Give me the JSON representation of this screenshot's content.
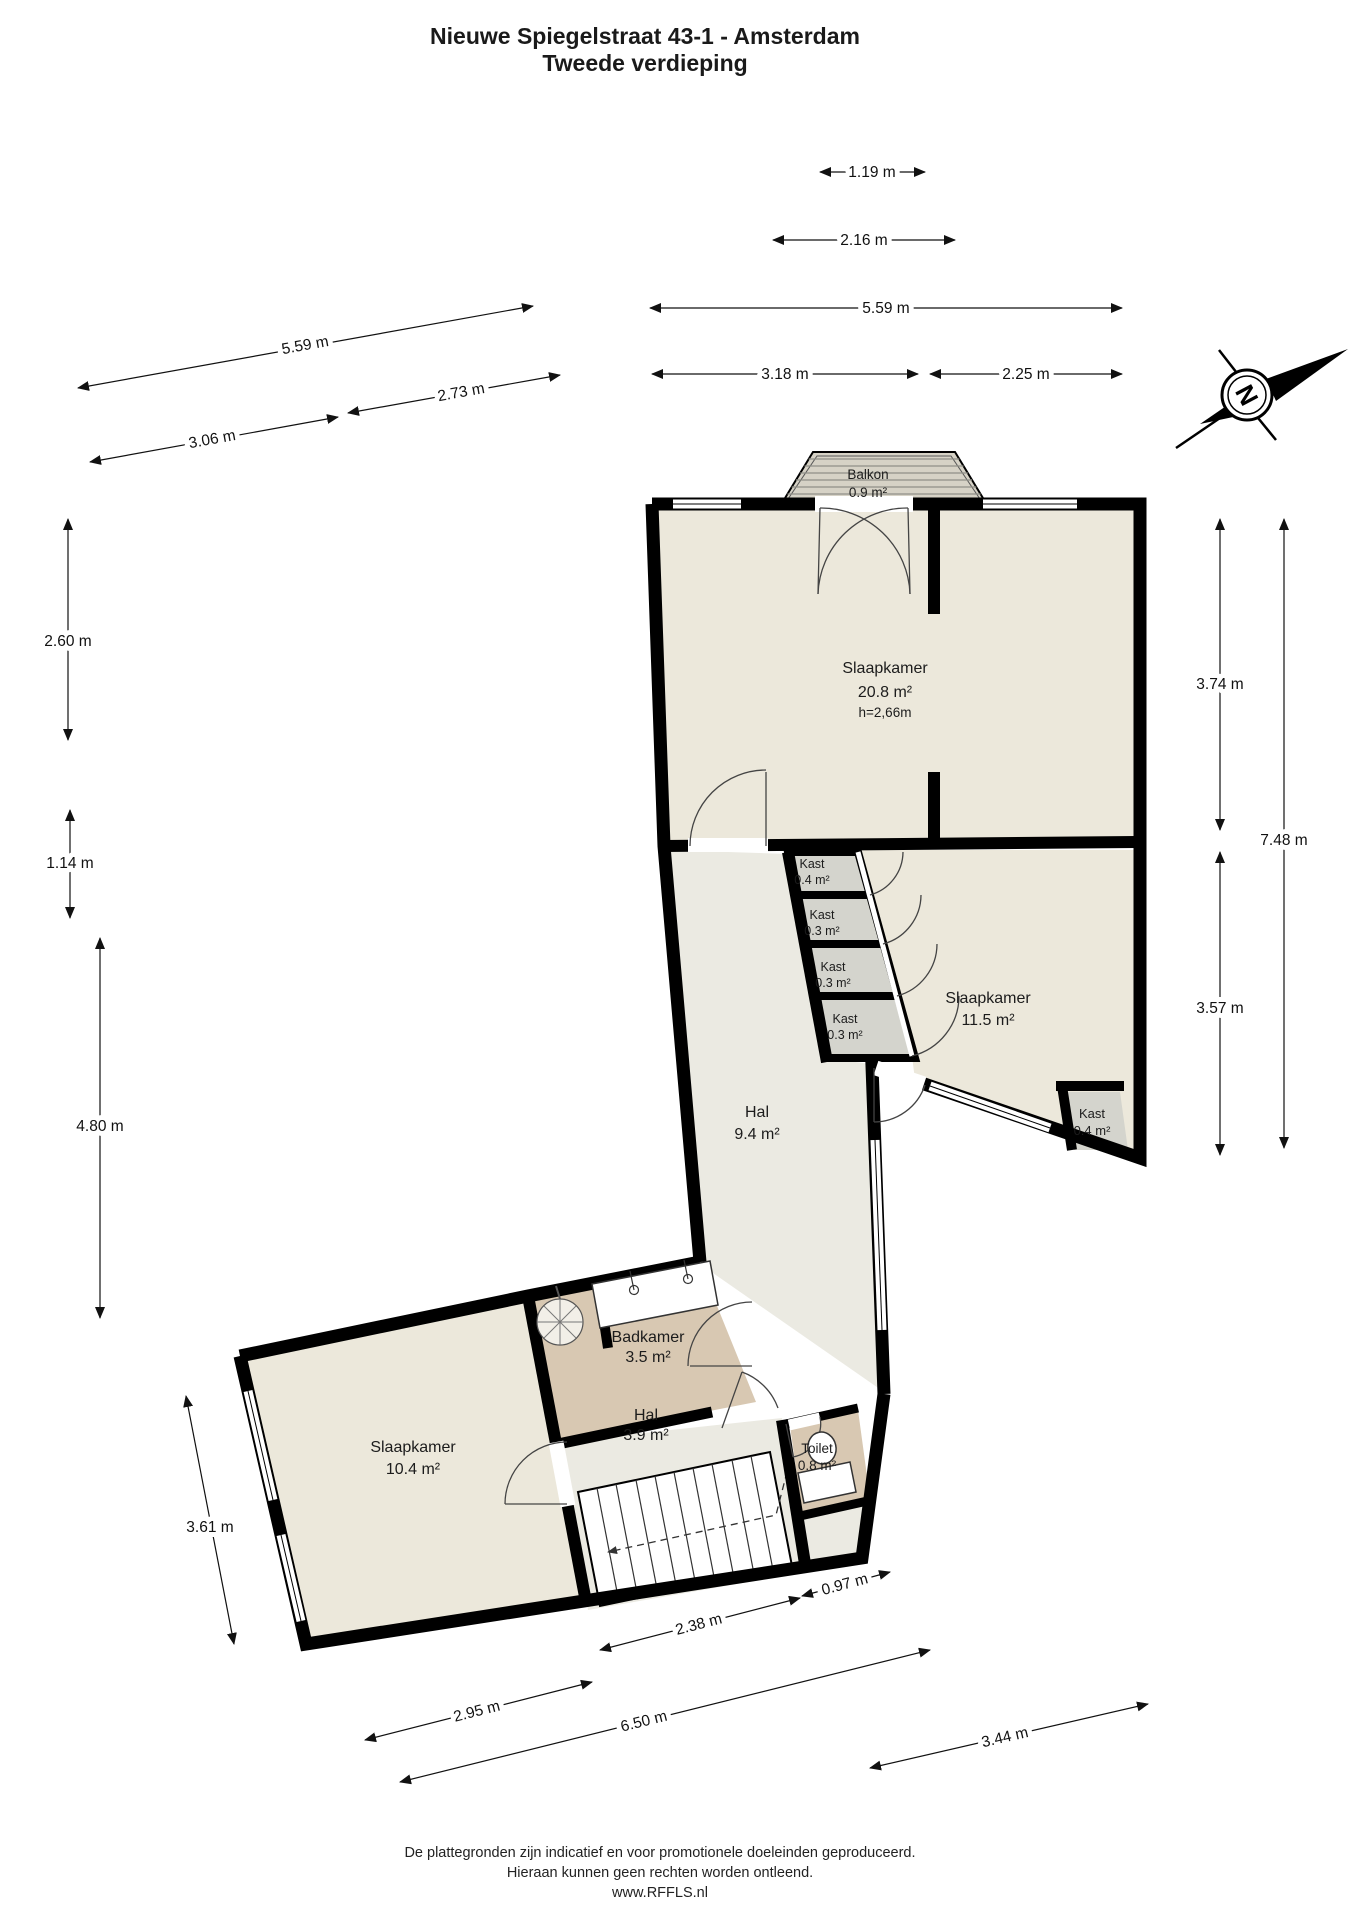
{
  "title": {
    "line1": "Nieuwe Spiegelstraat 43-1 - Amsterdam",
    "line2": "Tweede verdieping"
  },
  "compass": {
    "north_label": "N"
  },
  "rooms": [
    {
      "name": "Balkon",
      "area": "0.9 m²"
    },
    {
      "name": "Slaapkamer",
      "area": "20.8 m²",
      "height": "h=2,66m"
    },
    {
      "name": "Kast",
      "area": "0.4 m²"
    },
    {
      "name": "Kast",
      "area": "0.3 m²"
    },
    {
      "name": "Kast",
      "area": "0.3 m²"
    },
    {
      "name": "Kast",
      "area": "0.3 m²"
    },
    {
      "name": "Slaapkamer",
      "area": "11.5 m²"
    },
    {
      "name": "Kast",
      "area": "0.4 m²"
    },
    {
      "name": "Hal",
      "area": "9.4 m²"
    },
    {
      "name": "Badkamer",
      "area": "3.5 m²"
    },
    {
      "name": "Hal",
      "area": "3.9 m²"
    },
    {
      "name": "Toilet",
      "area": "0.8 m²"
    },
    {
      "name": "Slaapkamer",
      "area": "10.4 m²"
    }
  ],
  "dimensions": {
    "balkon_top": "1.19 m",
    "balkon_base": "2.16 m",
    "top_total": "5.59 m",
    "top_left": "3.18 m",
    "top_right": "2.25 m",
    "upper_left_total": "5.59 m",
    "upper_left_inner": "2.73 m",
    "lower_left_inner": "3.06 m",
    "left_v1": "2.60 m",
    "left_v2": "1.14 m",
    "left_v3": "4.80 m",
    "left_v4": "3.61 m",
    "right_v1": "3.74 m",
    "right_v2": "7.48 m",
    "right_v3": "3.57 m",
    "bottom_1": "0.97 m",
    "bottom_2": "2.38 m",
    "bottom_3": "2.95 m",
    "bottom_4": "6.50 m",
    "bottom_5": "3.44 m"
  },
  "colors": {
    "wall": "#000000",
    "room_fill": "#ECE8DB",
    "hall_fill": "#EBEAE2",
    "wet_room_fill": "#D8C8B2",
    "closet_fill": "#D4D4CD",
    "balcony_fill": "#D6D2C6"
  },
  "footer": {
    "line1": "De plattegronden zijn indicatief en voor promotionele doeleinden geproduceerd.",
    "line2": "Hieraan kunnen geen rechten worden ontleend.",
    "line3": "www.RFFLS.nl"
  }
}
